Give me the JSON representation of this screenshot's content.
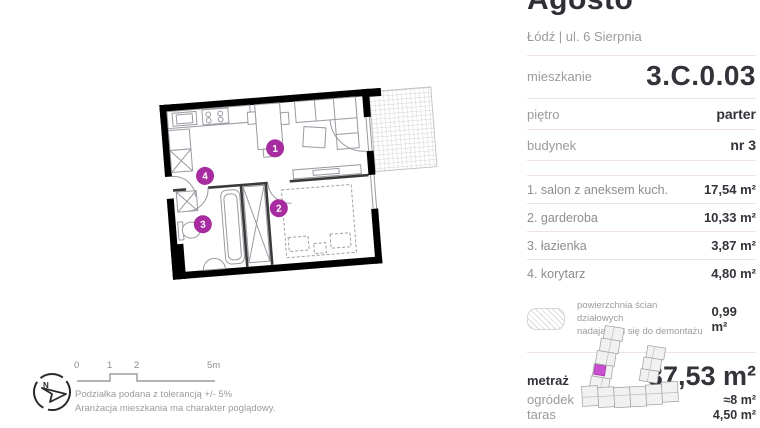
{
  "header": {
    "title": "Agosto",
    "location": "Łódź | ul. 6 Sierpnia"
  },
  "info": {
    "rows": [
      {
        "label": "mieszkanie",
        "value": "3.C.0.03"
      },
      {
        "label": "piętro",
        "value": "parter"
      },
      {
        "label": "budynek",
        "value": "nr 3"
      }
    ]
  },
  "rooms": [
    {
      "label": "1. salon z aneksem kuch.",
      "value": "17,54 m²"
    },
    {
      "label": "2. garderoba",
      "value": "10,33 m²"
    },
    {
      "label": "3. łazienka",
      "value": "3,87 m²"
    },
    {
      "label": "4. korytarz",
      "value": "4,80 m²"
    }
  ],
  "demolishable": {
    "note_line1": "powierzchnia ścian działowych",
    "note_line2": "nadających się do demontażu",
    "value": "0,99 m²"
  },
  "summary": {
    "rows": [
      {
        "label": "metraż",
        "value": "37,53 m²"
      },
      {
        "label": "ogródek",
        "value": "≈8 m²"
      },
      {
        "label": "taras",
        "value": "4,50 m²"
      }
    ]
  },
  "plan": {
    "markers": [
      {
        "label": "1"
      },
      {
        "label": "2"
      },
      {
        "label": "3"
      },
      {
        "label": "4"
      }
    ],
    "marker_color": "#a62c9f"
  },
  "compass": {
    "label": "N"
  },
  "scale": {
    "ticks": [
      "0",
      "1",
      "2",
      "5m"
    ],
    "note1": "Podziałka podana z tolerancją +/- 5%",
    "note2": "Aranżacja mieszkania ma charakter poglądowy."
  },
  "colors": {
    "accent": "#a62c9f",
    "wall": "#000000",
    "divider": "#f0e2e2",
    "text_dark": "#33333a",
    "text_gray": "#9b9b9b"
  }
}
